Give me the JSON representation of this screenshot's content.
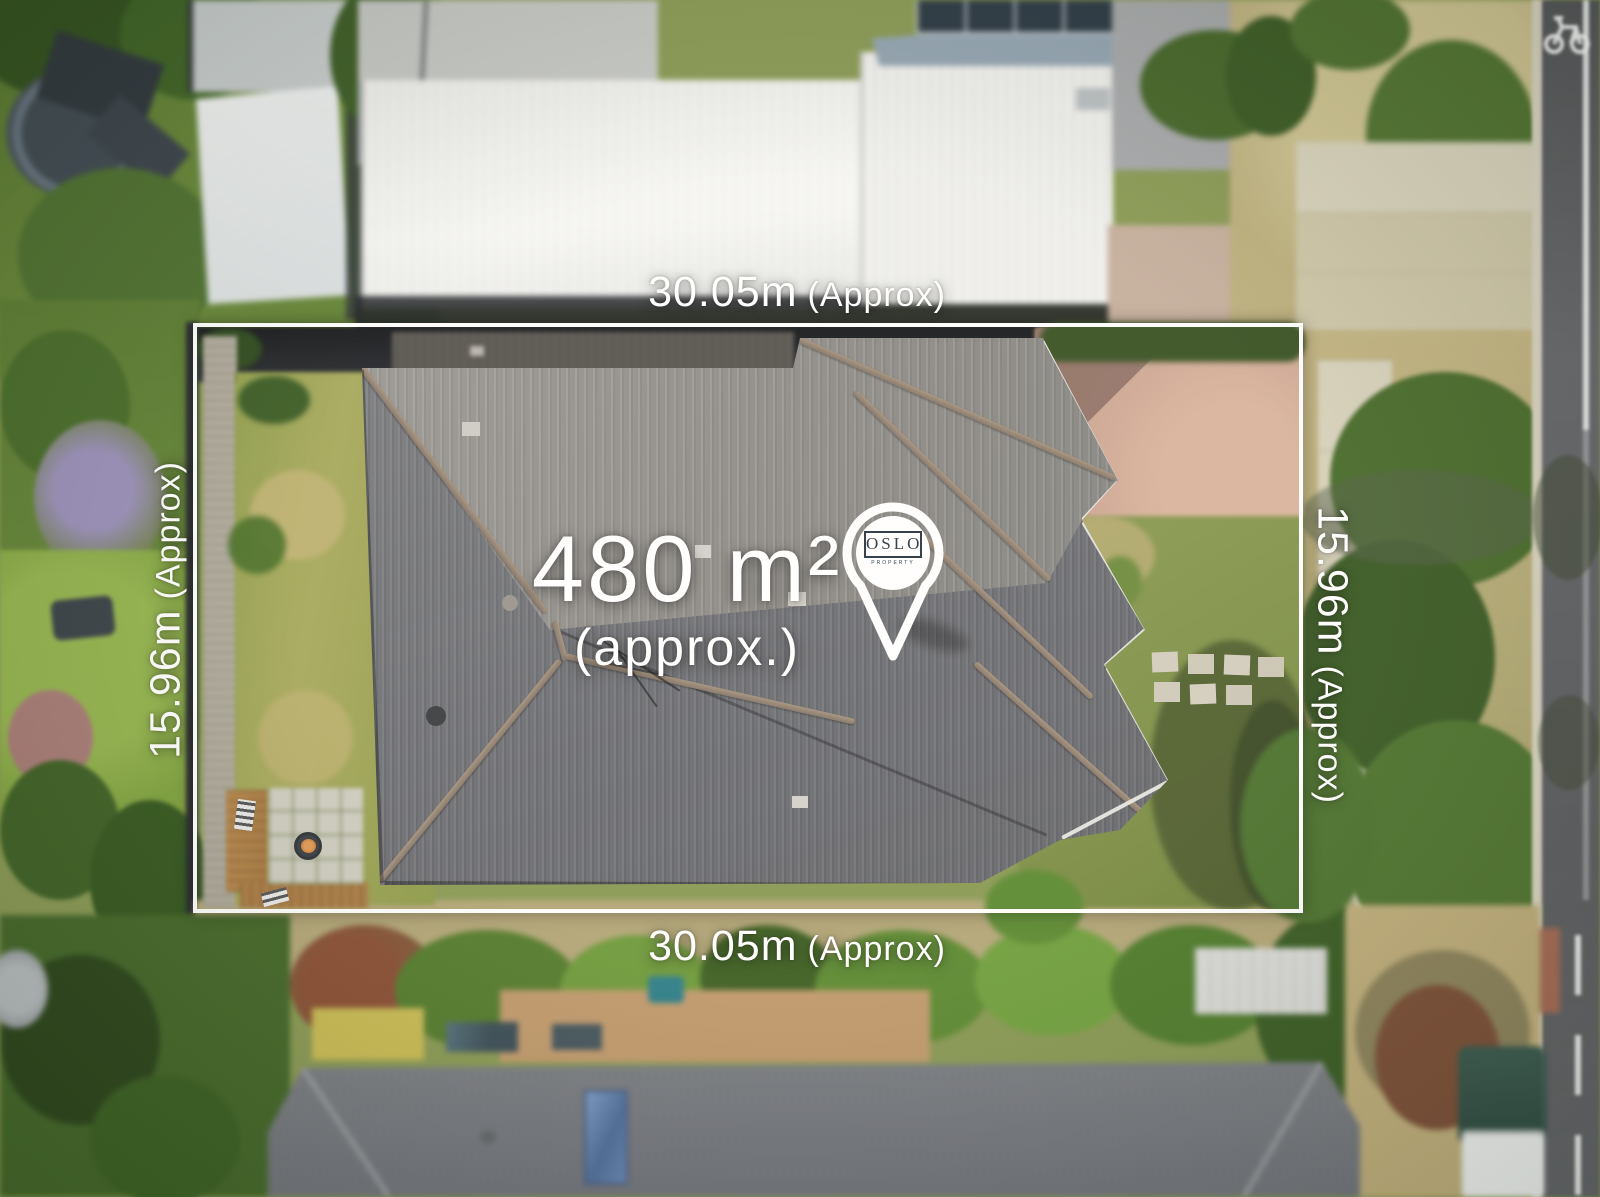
{
  "annotations": {
    "area": {
      "value": "480 m²",
      "qualifier": "(approx.)"
    },
    "width_top": {
      "value": "30.05m",
      "qualifier": "(Approx)"
    },
    "width_bottom": {
      "value": "30.05m",
      "qualifier": "(Approx)"
    },
    "depth_left": {
      "value": "15.96m",
      "qualifier": "(Approx)"
    },
    "depth_right": {
      "value": "15.96m",
      "qualifier": "(Approx)"
    }
  },
  "pin": {
    "brand": "OSLO",
    "brand_subtext": "PROPERTY"
  },
  "icons": {
    "pin": "location-pin",
    "bike_lane": "bicycle-lane-marking"
  },
  "colors": {
    "boundary": "#ffffff",
    "annotation_text": "#ffffff",
    "pin": "#ffffff",
    "logo_text": "#2c3945"
  }
}
